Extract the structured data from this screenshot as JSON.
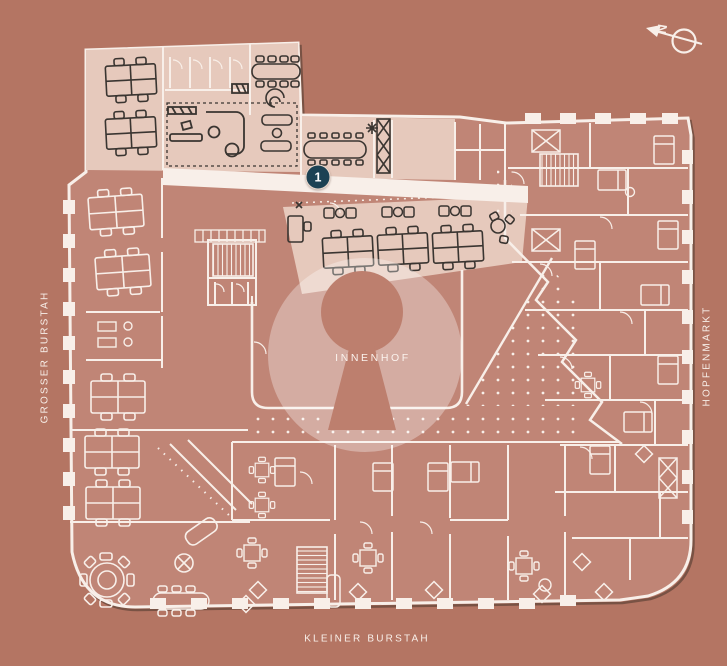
{
  "plan": {
    "streets": {
      "left": "GROSSER BURSTAH",
      "right": "HOPFENMARKT",
      "bottom": "KLEINER BURSTAH"
    },
    "courtyard": {
      "label": "INNENHOF"
    },
    "marker": {
      "number": "1"
    },
    "compass": {
      "letter": "N"
    },
    "colors": {
      "background": "#b47563",
      "room_fill": "#c08576",
      "highlight_fill": "#e6c9bc",
      "line_white": "#f8efe9",
      "furniture_dark": "#3a3531",
      "marker_fill": "#1c4254",
      "marker_ring": "#ead9cd",
      "courtyard_circle": "rgba(255,255,255,0.32)",
      "keyhole_fill": "#bd7f6e"
    }
  }
}
